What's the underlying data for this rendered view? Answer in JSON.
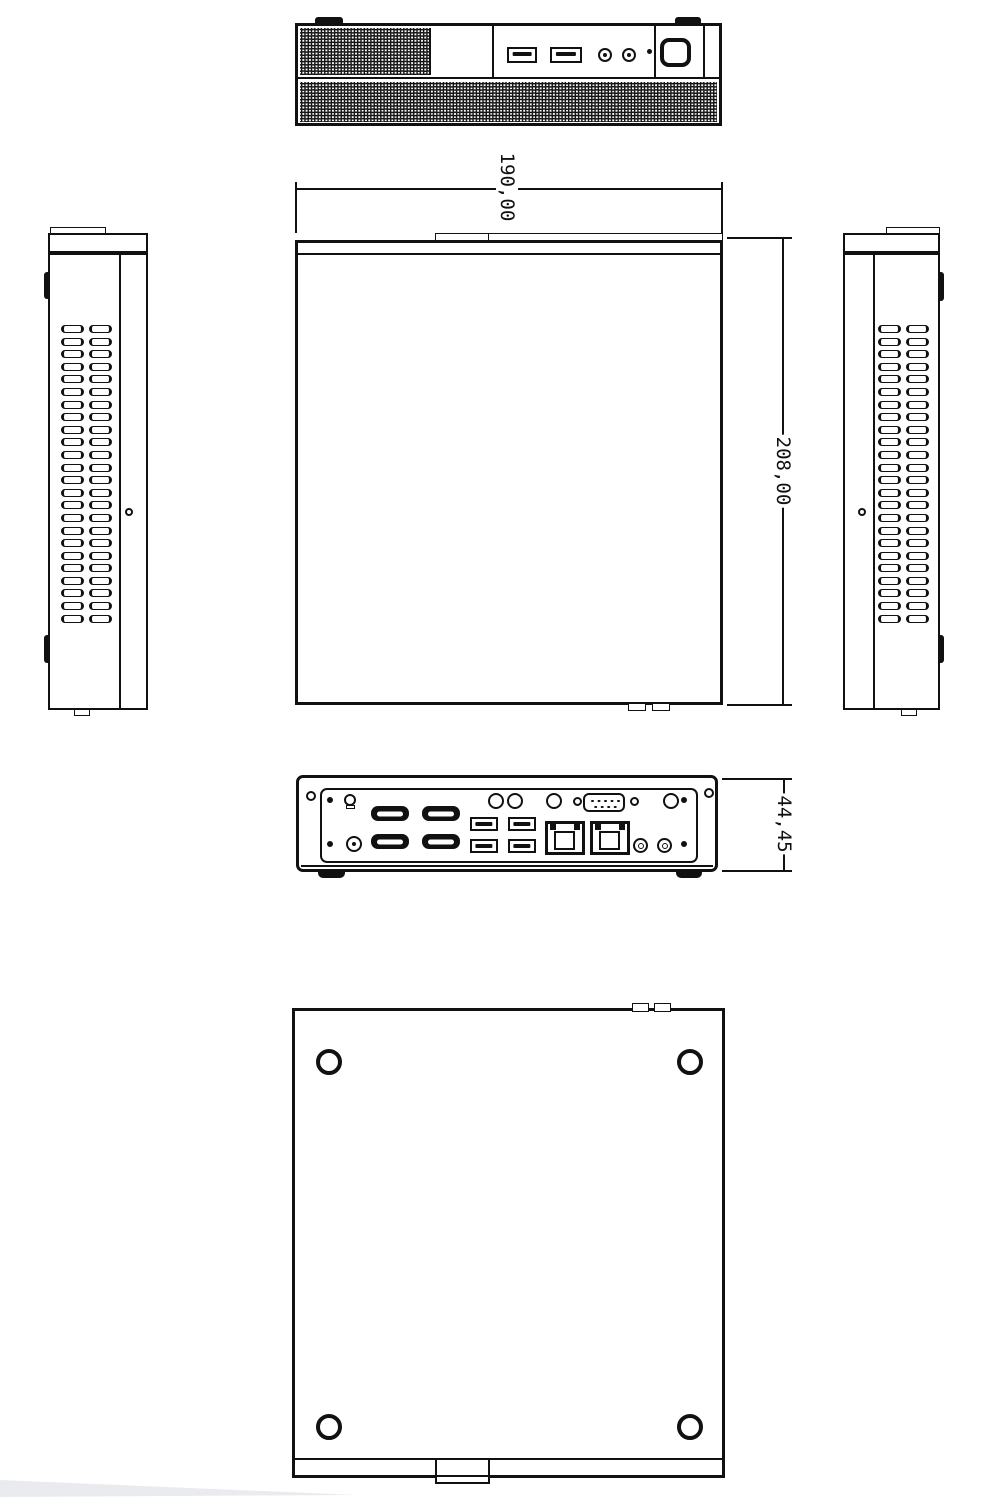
{
  "drawing": {
    "subject": "mini-pc-enclosure-dimension-drawing",
    "line_color": "#111111",
    "background_color": "#ffffff",
    "wedge_color": "#e9ebee"
  },
  "dimensions": {
    "width": "190,00",
    "depth": "208,00",
    "rear_height": "44,45"
  },
  "repeats": {
    "side_vent_rows": 24,
    "side_vent_cols": 2
  },
  "icons": {
    "front_ports": [
      "usb-a",
      "usb-a",
      "audio-jack",
      "audio-jack",
      "power-led",
      "power-button"
    ],
    "rear_ports": [
      "kensington-lock",
      "dc-jack",
      "hdmi",
      "hdmi",
      "hdmi",
      "hdmi",
      "usb-a",
      "usb-a",
      "usb-a",
      "usb-a",
      "rj45",
      "rj45",
      "antenna-hole",
      "antenna-hole",
      "antenna-hole",
      "antenna-hole",
      "db9-serial",
      "audio-jack",
      "audio-jack"
    ]
  }
}
